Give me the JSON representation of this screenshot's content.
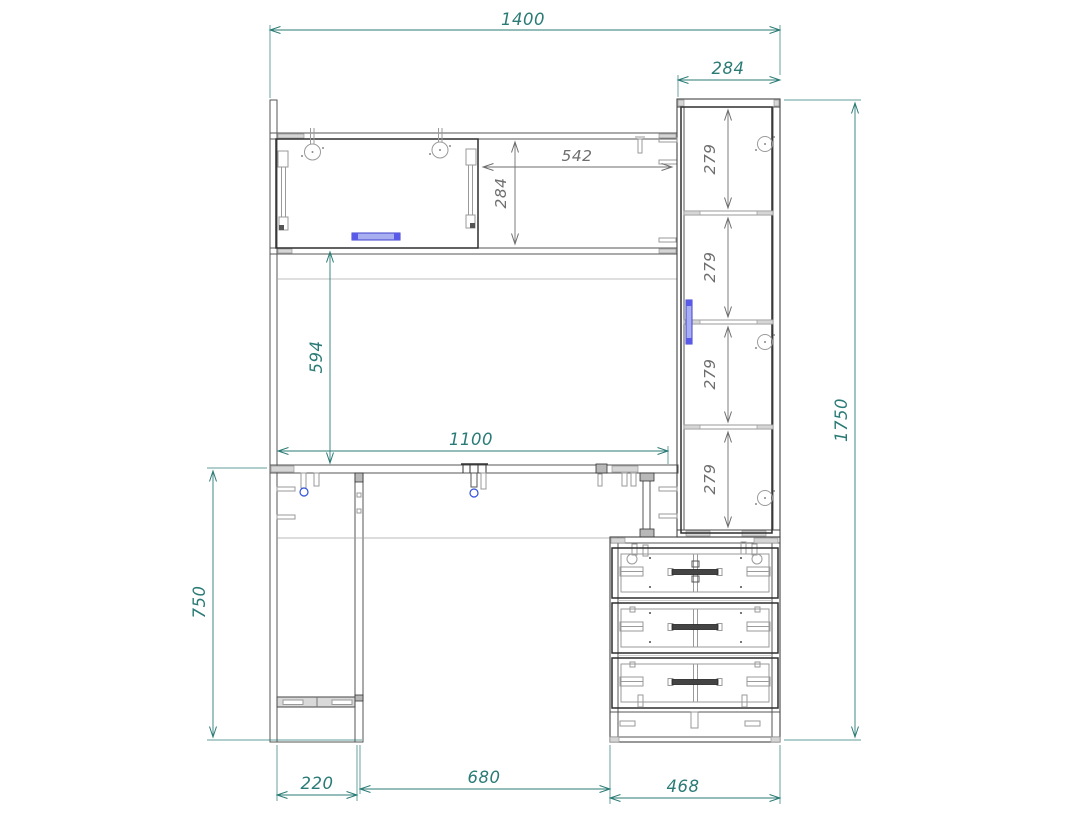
{
  "drawing": {
    "view": "front-view-furniture-assembly-drawing",
    "units": "mm",
    "dims": {
      "overall_width": "1400",
      "overall_height": "1750",
      "top_cabinet_width": "284",
      "shelf_opening_width": "542",
      "shelf_opening_height": "284",
      "under_shelf_height": "594",
      "desk_opening_width": "1100",
      "desk_height": "750",
      "left_leg_depth": "220",
      "kneehole_width": "680",
      "drawer_unit_width": "468",
      "cabinet_section_heights": [
        "279",
        "279",
        "279",
        "279"
      ]
    },
    "colors": {
      "dimension_primary": "#2a7b76",
      "dimension_secondary": "#6e6e6e",
      "outline_dark": "#2e2e2e",
      "outline_medium": "#555555",
      "detail_light": "#9a9a9a",
      "panel_fill": "#d6d6d6",
      "fitting_blue_stroke": "#3050dd",
      "handle_fill": "#a8aff0",
      "handle_cap_fill": "#5a5ae8",
      "background": "#ffffff"
    }
  }
}
